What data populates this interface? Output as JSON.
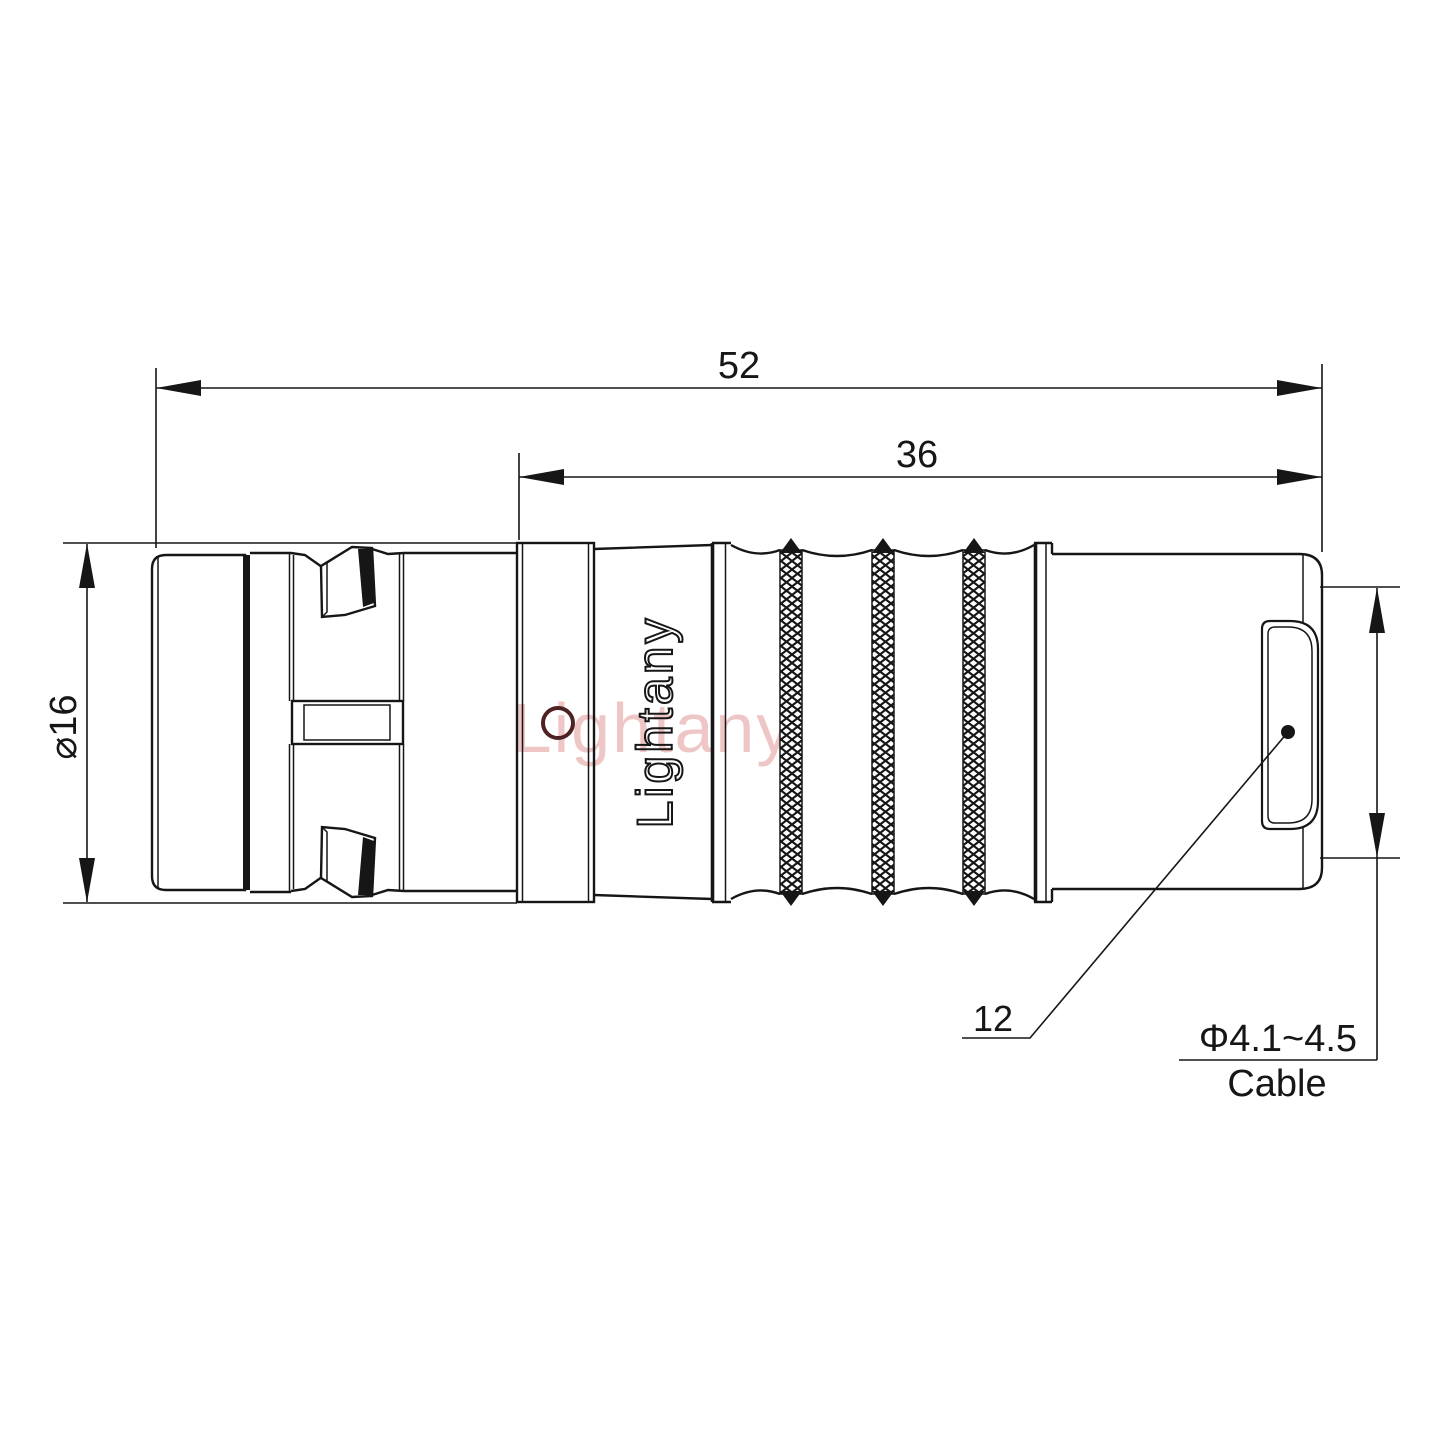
{
  "drawing": {
    "type": "connector-dimension-drawing",
    "watermark": {
      "text": "Lightany",
      "color": "#e29898"
    },
    "engraving": {
      "text": "Lightany"
    },
    "dimensions": {
      "overall_length": "52",
      "mid_length": "36",
      "diameter": "⌀16",
      "rear_label": "12",
      "cable_range": "Φ4.1~4.5",
      "cable_word": "Cable"
    },
    "colors": {
      "line": "#161616",
      "background": "#ffffff",
      "watermark_red": "#e29898",
      "hole_ring_accent": "#4e2222"
    }
  }
}
